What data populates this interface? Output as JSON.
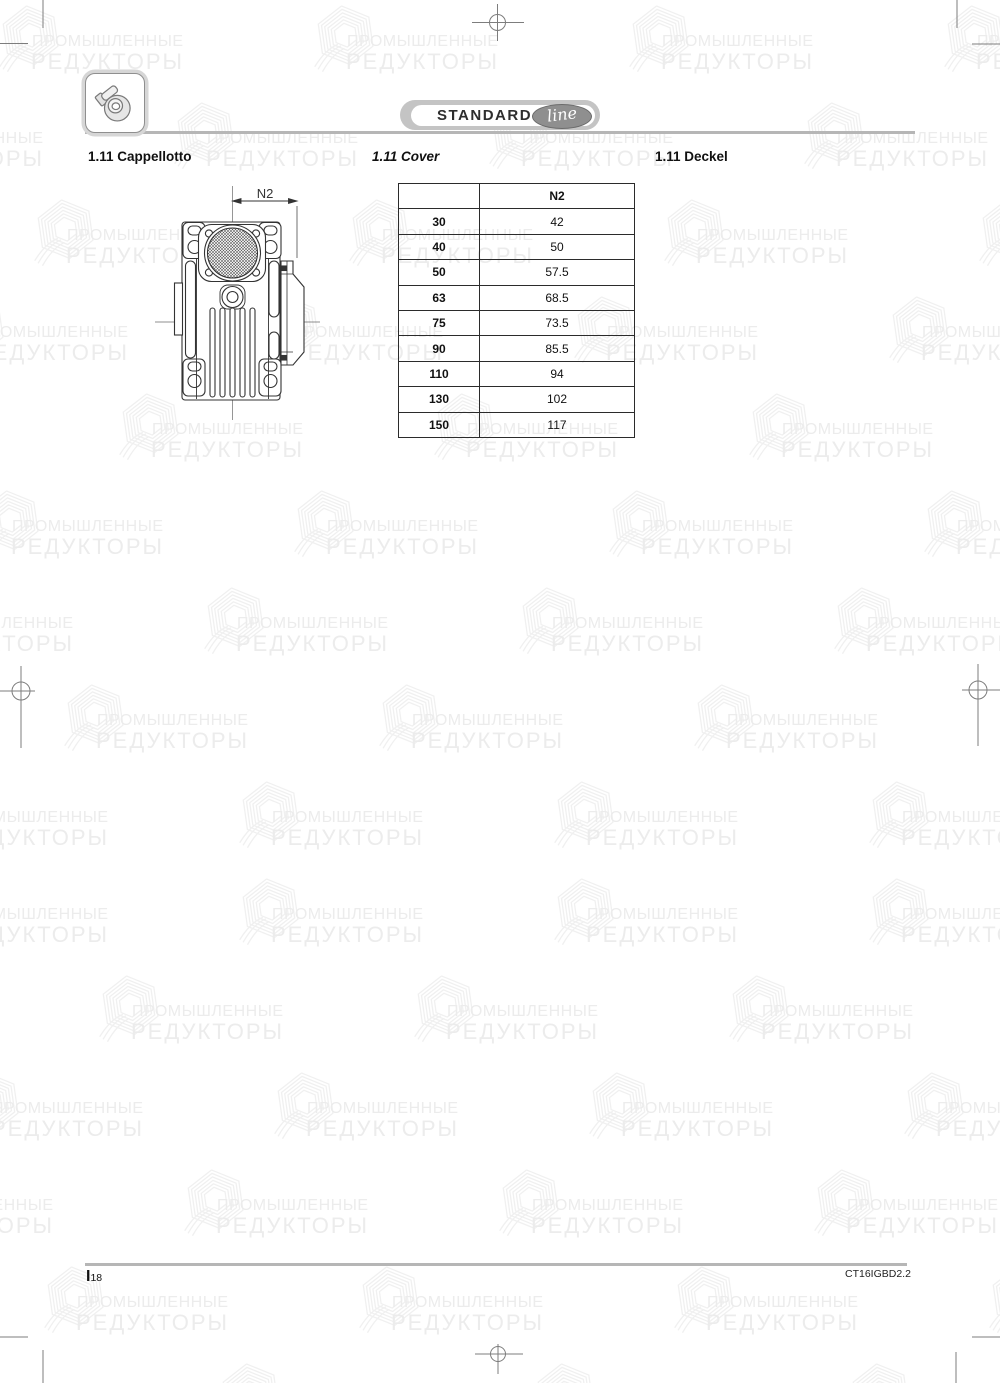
{
  "header": {
    "icon": "worm-gearbox-icon",
    "badge": {
      "label": "STANDARD",
      "script": "line"
    }
  },
  "sections": {
    "title_it": "1.11 Cappellotto",
    "title_en": "1.11 Cover",
    "title_de": "1.11 Deckel"
  },
  "drawing": {
    "dimension_label": "N2"
  },
  "table": {
    "col_header": "N2",
    "rows": [
      {
        "size": "30",
        "n2": "42"
      },
      {
        "size": "40",
        "n2": "50"
      },
      {
        "size": "50",
        "n2": "57.5"
      },
      {
        "size": "63",
        "n2": "68.5"
      },
      {
        "size": "75",
        "n2": "73.5"
      },
      {
        "size": "90",
        "n2": "85.5"
      },
      {
        "size": "110",
        "n2": "94"
      },
      {
        "size": "130",
        "n2": "102"
      },
      {
        "size": "150",
        "n2": "117"
      }
    ]
  },
  "watermark": {
    "line1": "ПРОМЫШЛЕННЫЕ",
    "line2": "РЕДУКТОРЫ"
  },
  "footer": {
    "page_prefix": "I",
    "page_number": "18",
    "doc_code": "CT16IGBD2.2"
  },
  "colors": {
    "rule_gray": "#b6b6b6",
    "badge_gray": "#c4c4c4",
    "badge_ellipse": "#8f8f8f",
    "line_dark": "#333333",
    "watermark_text": "#ececec",
    "watermark_logo": "#f0f0f0"
  }
}
